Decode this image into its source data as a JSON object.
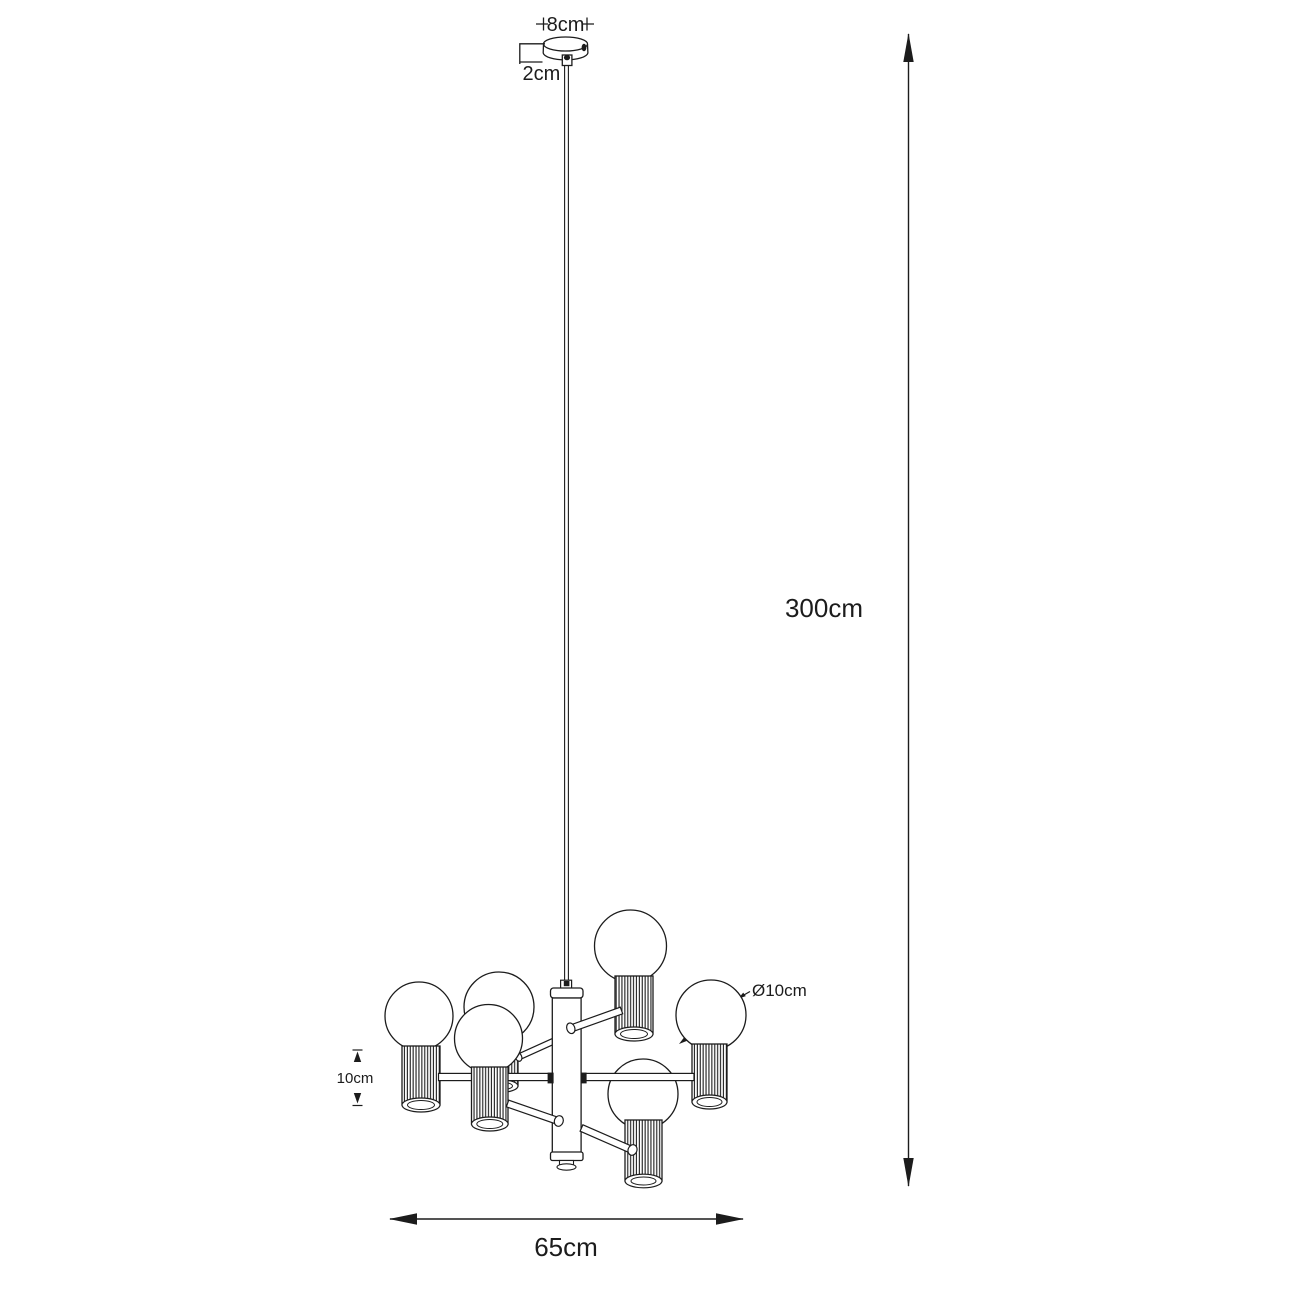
{
  "diagram": {
    "type": "dimension-drawing",
    "subject": "6-light pendant chandelier technical drawing",
    "colors": {
      "line": "#1c1c1c",
      "background": "#ffffff"
    },
    "labels": {
      "canopy_width": "8cm",
      "canopy_height": "2cm",
      "drop_height": "300cm",
      "bulb_diameter": "Ø10cm",
      "shade_height": "10cm",
      "fixture_width": "65cm"
    }
  }
}
